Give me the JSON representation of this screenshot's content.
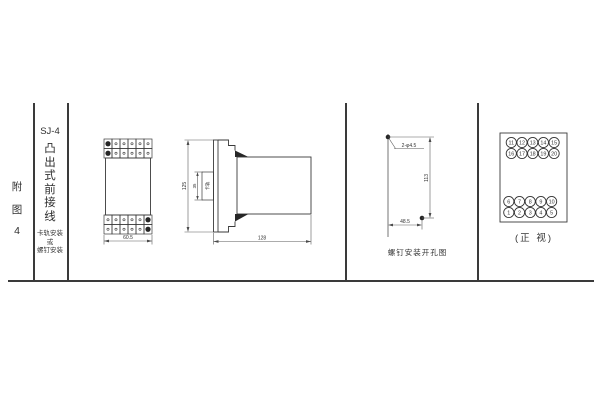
{
  "colors": {
    "line": "#3a3a3a",
    "dim_line": "#5a5a5a",
    "text": "#333333",
    "background": "#ffffff"
  },
  "sidebar": {
    "index_chars": [
      "附",
      "图",
      "4"
    ],
    "model": "SJ-4",
    "type_chars": [
      "凸",
      "出",
      "式",
      "前",
      "接",
      "线"
    ],
    "mount_note": [
      "卡轨安装",
      "或",
      "螺钉安装"
    ]
  },
  "front_view": {
    "width_dim": "60.5"
  },
  "side_view": {
    "height_dim": "125",
    "rail_height_dim": "35",
    "rail_label": "卡轨",
    "depth_dim": "128"
  },
  "drill_view": {
    "holes_label": "2-φ4.5",
    "vertical_dim": "113",
    "horizontal_dim": "48.5",
    "caption": "螺钉安装开孔图"
  },
  "terminal_view": {
    "rows": {
      "top": [
        [
          "11",
          "12",
          "13",
          "14",
          "15"
        ],
        [
          "16",
          "17",
          "18",
          "19",
          "20"
        ]
      ],
      "bottom": [
        [
          "6",
          "7",
          "8",
          "9",
          "10"
        ],
        [
          "1",
          "2",
          "3",
          "4",
          "5"
        ]
      ]
    },
    "caption": "(正 视)"
  }
}
